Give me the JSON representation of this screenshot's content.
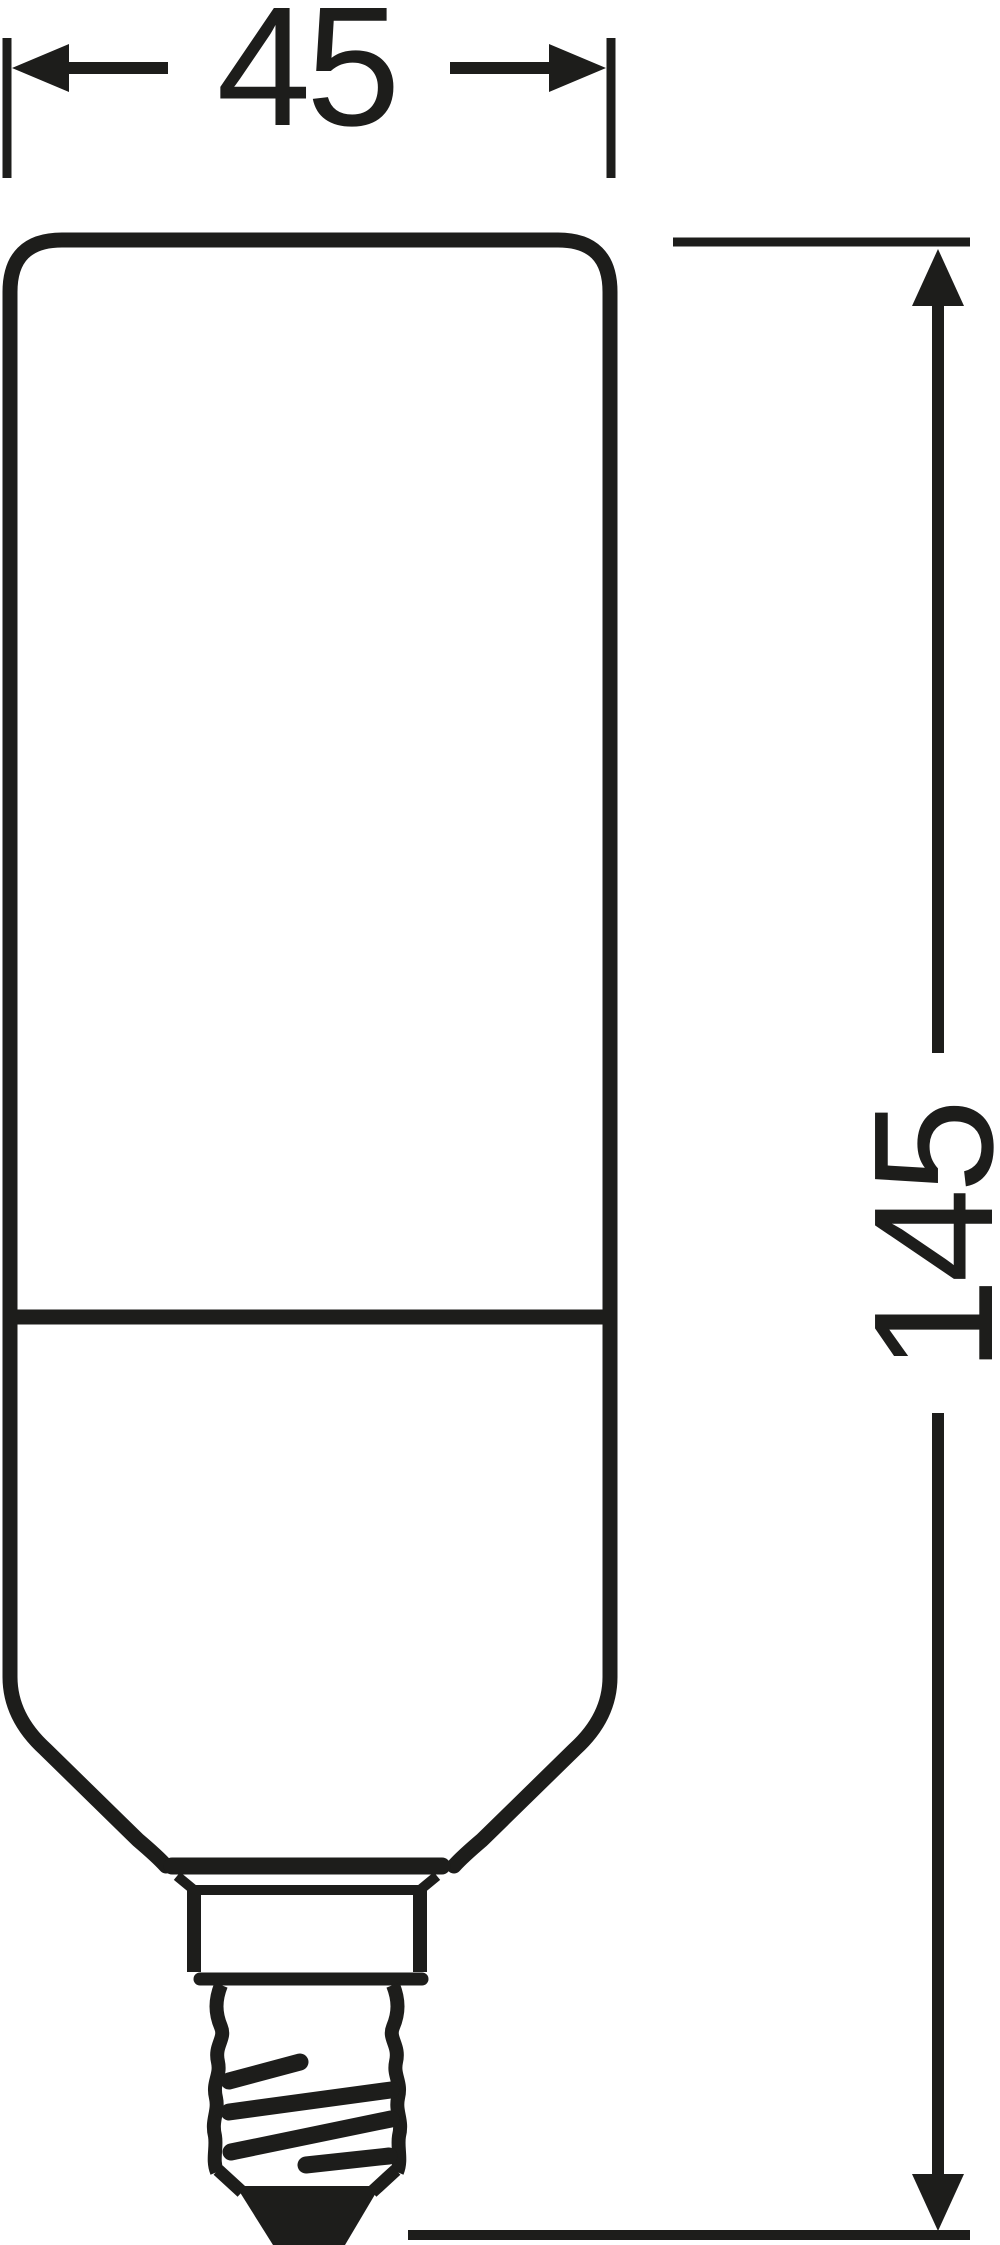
{
  "diagram": {
    "type": "technical-dimension-drawing",
    "subject": "tubular lamp with screw base, front outline view",
    "background_color": "#ffffff",
    "line_color": "#1d1d1b",
    "dimensions": {
      "width": {
        "label": "45",
        "orientation": "horizontal"
      },
      "height": {
        "label": "145",
        "orientation": "vertical"
      }
    }
  }
}
